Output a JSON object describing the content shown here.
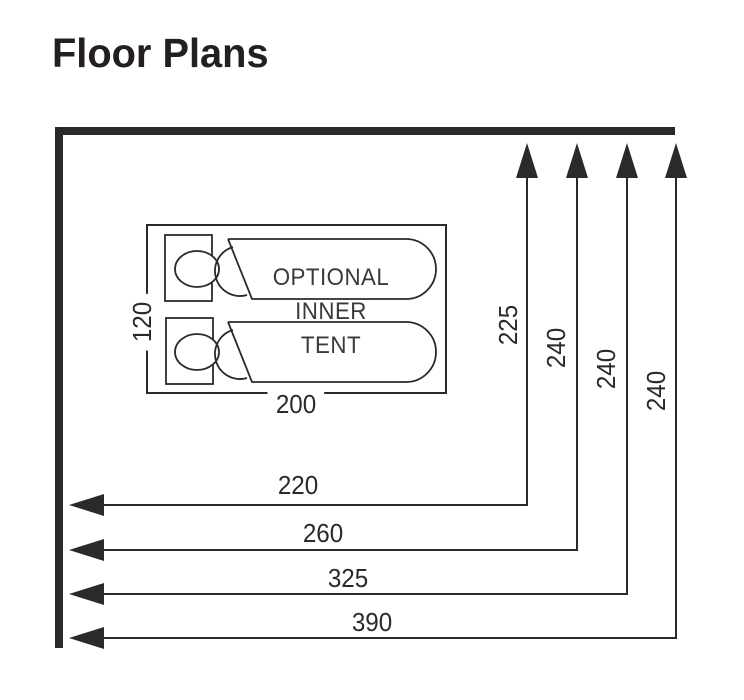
{
  "title": "Floor Plans",
  "inner_tent": {
    "label": [
      "OPTIONAL",
      "INNER",
      "TENT"
    ],
    "width_label": "200",
    "depth_label": "120"
  },
  "dimensions": {
    "vertical_arrows": [
      {
        "label": "225"
      },
      {
        "label": "240"
      },
      {
        "label": "240"
      },
      {
        "label": "240"
      }
    ],
    "horizontal_arrows": [
      {
        "label": "220"
      },
      {
        "label": "260"
      },
      {
        "label": "325"
      },
      {
        "label": "390"
      }
    ]
  },
  "colors": {
    "line": "#2b2a29",
    "text": "#3a3a39",
    "background": "#ffffff"
  }
}
